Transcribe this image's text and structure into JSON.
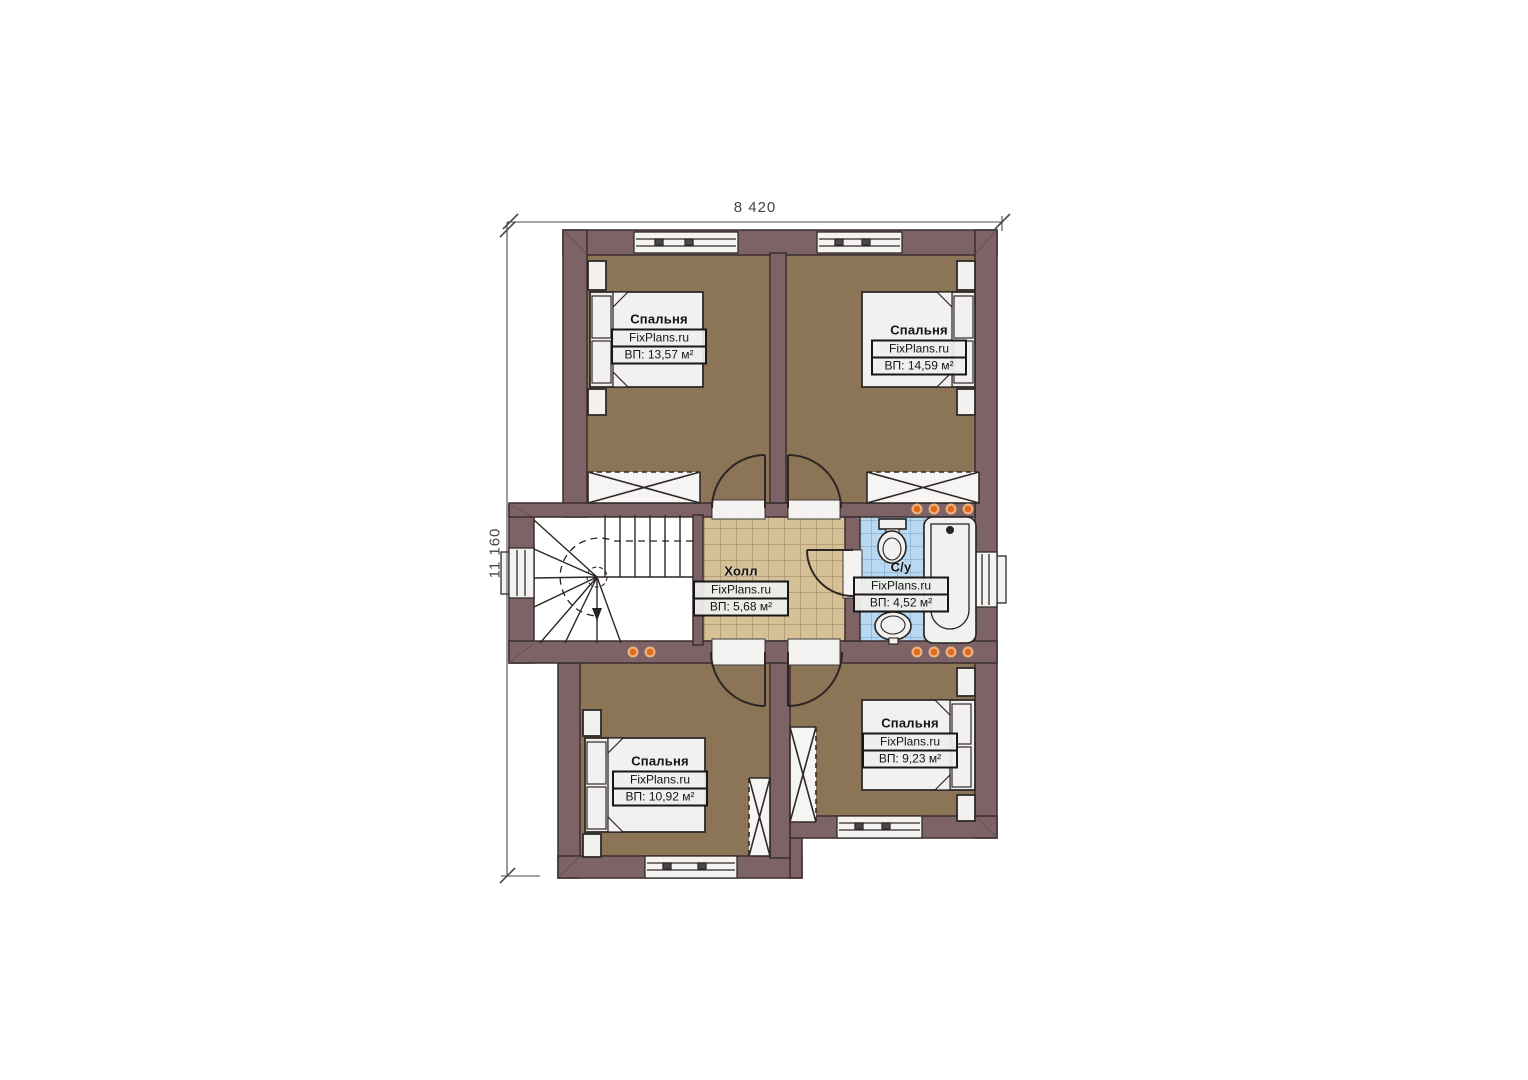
{
  "dimensions": {
    "width_label": "8 420",
    "height_label": "11 160"
  },
  "rooms": [
    {
      "id": "bedroom-top-left",
      "name": "Спальня",
      "brand": "FixPlans.ru",
      "area": "ВП: 13,57 м²"
    },
    {
      "id": "bedroom-top-right",
      "name": "Спальня",
      "brand": "FixPlans.ru",
      "area": "ВП: 14,59 м²"
    },
    {
      "id": "hall",
      "name": "Холл",
      "brand": "FixPlans.ru",
      "area": "ВП: 5,68 м²"
    },
    {
      "id": "bathroom",
      "name": "С/у",
      "brand": "FixPlans.ru",
      "area": "ВП: 4,52 м²"
    },
    {
      "id": "bedroom-bottom-left",
      "name": "Спальня",
      "brand": "FixPlans.ru",
      "area": "ВП: 10,92 м²"
    },
    {
      "id": "bedroom-bottom-right",
      "name": "Спальня",
      "brand": "FixPlans.ru",
      "area": "ВП: 9,23 м²"
    }
  ],
  "colors": {
    "wall": "#7d6366",
    "wall-stroke": "#3b2d30",
    "floor-bedroom": "#8c7456",
    "floor-hall": "#d6c196",
    "floor-bath": "#b9d8f1",
    "bath-grid": "#5d8cc0",
    "furniture": "#f2f1ef",
    "dot": "#dd6a1f",
    "dim": "#454545"
  }
}
